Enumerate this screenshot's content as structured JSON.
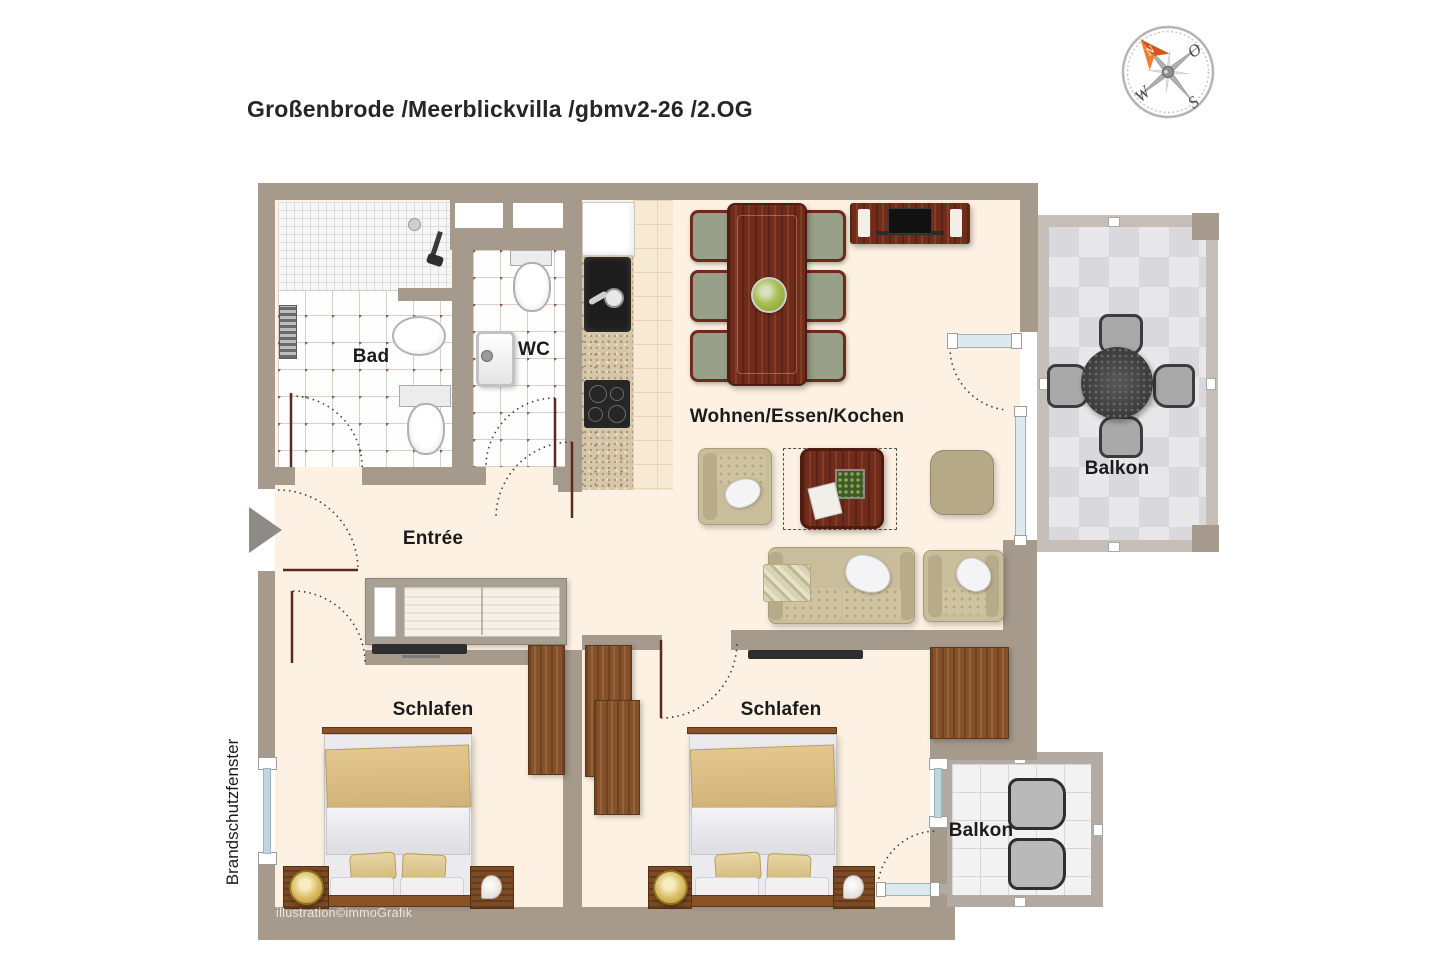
{
  "header": {
    "title": "Großenbrode /Meerblickvilla /gbmv2-26 /2.OG"
  },
  "compass": {
    "north": "N",
    "east": "O",
    "south": "S",
    "west": "W"
  },
  "rooms": {
    "bad": {
      "label": "Bad"
    },
    "wc": {
      "label": "WC"
    },
    "entree": {
      "label": "Entrée"
    },
    "living": {
      "label": "Wohnen/Essen/Kochen"
    },
    "bedroom_left": {
      "label": "Schlafen"
    },
    "bedroom_right": {
      "label": "Schlafen"
    },
    "balcony_right": {
      "label": "Balkon"
    },
    "balcony_bottom": {
      "label": "Balkon"
    }
  },
  "annotations": {
    "fire_protection_window": "Brandschutzfenster",
    "watermark": "illustration©immoGrafik"
  },
  "colors": {
    "wall": "#a69a8d",
    "floor": "#fcf1e2",
    "bath_tile_dot": "#8d5f4c",
    "kitchen_counter": "#d6c7ab",
    "mahogany": "#702c1b",
    "wardrobe_wood": "#84512a",
    "sofa_beige": "#c9bd9c",
    "blanket_tan": "#d9bb80",
    "balcony_tile": "#e8e8eb",
    "window_glass": "#bcd8de",
    "compass_arrow": "#e8641f",
    "door_leaf": "#5a2b1b"
  }
}
